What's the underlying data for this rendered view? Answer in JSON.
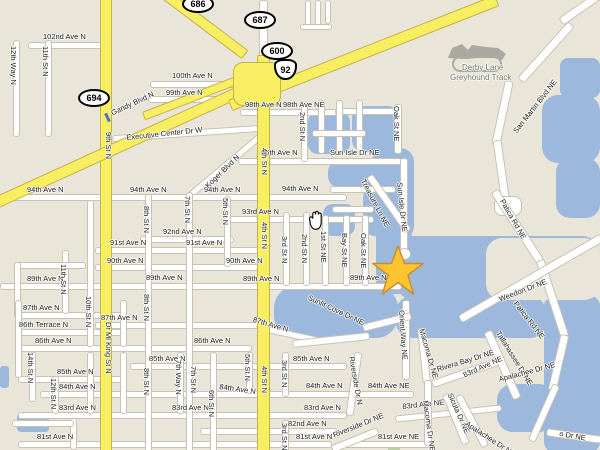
{
  "map": {
    "colors": {
      "land": "#E9E5D8",
      "water": "#9CB8DC",
      "road": "#FFFFFF",
      "highway": "#F7EE61",
      "highway_border": "#C6B14A",
      "building": "#A9A9A1",
      "star": "#FDC431",
      "star_border": "#C98F2F",
      "label": "#1c1c1c",
      "poi_label": "#6F7468"
    },
    "poi": {
      "derby_line1": "Derby Lane",
      "derby_line2": "Greyhound Track"
    },
    "marker": {
      "type": "star-icon"
    },
    "cursor": {
      "type": "hand-icon"
    },
    "shields": [
      {
        "t": "686",
        "x": 182,
        "y": -5,
        "k": "oval"
      },
      {
        "t": "687",
        "x": 244,
        "y": 11,
        "k": "oval"
      },
      {
        "t": "600",
        "x": 261,
        "y": 42,
        "k": "oval"
      },
      {
        "t": "92",
        "x": 274,
        "y": 59,
        "k": "us"
      },
      {
        "t": "694",
        "x": 78,
        "y": 89,
        "k": "oval"
      }
    ],
    "labels": [
      {
        "t": "102nd Ave N",
        "x": 43,
        "y": 33
      },
      {
        "t": "100th Ave N",
        "x": 172,
        "y": 72
      },
      {
        "t": "99th Ave N",
        "x": 166,
        "y": 89
      },
      {
        "t": "98th Ave N",
        "x": 245,
        "y": 101
      },
      {
        "t": "98th Ave NE",
        "x": 283,
        "y": 101
      },
      {
        "t": "96th Ave N",
        "x": 261,
        "y": 149
      },
      {
        "t": "Sun Isle Dr NE",
        "x": 330,
        "y": 149
      },
      {
        "t": "94th Ave N",
        "x": 27,
        "y": 186
      },
      {
        "t": "94th Ave N",
        "x": 130,
        "y": 186
      },
      {
        "t": "94th Ave N",
        "x": 204,
        "y": 186
      },
      {
        "t": "94th Ave N",
        "x": 282,
        "y": 185
      },
      {
        "t": "93rd Ave N",
        "x": 242,
        "y": 208
      },
      {
        "t": "92nd Ave N",
        "x": 163,
        "y": 228
      },
      {
        "t": "91st Ave N",
        "x": 110,
        "y": 239
      },
      {
        "t": "91st Ave N",
        "x": 186,
        "y": 239
      },
      {
        "t": "90th Ave N",
        "x": 107,
        "y": 257
      },
      {
        "t": "90th Ave N",
        "x": 226,
        "y": 257
      },
      {
        "t": "89th Ave N",
        "x": 27,
        "y": 275
      },
      {
        "t": "89th Ave N",
        "x": 146,
        "y": 274
      },
      {
        "t": "89th Ave N",
        "x": 243,
        "y": 275
      },
      {
        "t": "89th Ave N",
        "x": 350,
        "y": 274
      },
      {
        "t": "87th Ave N",
        "x": 23,
        "y": 304
      },
      {
        "t": "86th Terrace N",
        "x": 19,
        "y": 321
      },
      {
        "t": "86th Ave N",
        "x": 35,
        "y": 337
      },
      {
        "t": "86th Ave N",
        "x": 194,
        "y": 337
      },
      {
        "t": "87th Ave N",
        "x": 101,
        "y": 314
      },
      {
        "t": "87th Ave N",
        "x": 254,
        "y": 316,
        "r": 16
      },
      {
        "t": "85th Ave N",
        "x": 57,
        "y": 368
      },
      {
        "t": "85th Ave N",
        "x": 149,
        "y": 355
      },
      {
        "t": "85th Ave N",
        "x": 293,
        "y": 355
      },
      {
        "t": "84th Ave N",
        "x": 59,
        "y": 383
      },
      {
        "t": "84th Ave N",
        "x": 220,
        "y": 383,
        "r": 8
      },
      {
        "t": "84th Ave N",
        "x": 306,
        "y": 382
      },
      {
        "t": "84th Ave NE",
        "x": 368,
        "y": 382
      },
      {
        "t": "83rd Ave N",
        "x": 59,
        "y": 404
      },
      {
        "t": "83rd Ave N",
        "x": 172,
        "y": 404
      },
      {
        "t": "83rd Ave N",
        "x": 304,
        "y": 404
      },
      {
        "t": "83rd Ave NE",
        "x": 402,
        "y": 403,
        "r": -6
      },
      {
        "t": "83rd Ave NE",
        "x": 462,
        "y": 372,
        "r": -24
      },
      {
        "t": "82nd Ave N",
        "x": 288,
        "y": 420
      },
      {
        "t": "81st Ave N",
        "x": 37,
        "y": 433
      },
      {
        "t": "81st Ave N",
        "x": 296,
        "y": 433
      },
      {
        "t": "81st Ave NE",
        "x": 378,
        "y": 433
      },
      {
        "t": "12th Way N",
        "x": 17,
        "y": 46,
        "r": 90
      },
      {
        "t": "11th St N",
        "x": 49,
        "y": 46,
        "r": 90
      },
      {
        "t": "9th St N",
        "x": 112,
        "y": 132,
        "r": 90
      },
      {
        "t": "Gandy Blvd N",
        "x": 110,
        "y": 110,
        "r": -25
      },
      {
        "t": "Executive Center Dr W",
        "x": 126,
        "y": 134,
        "r": -6
      },
      {
        "t": "Koger Blvd N",
        "x": 204,
        "y": 184,
        "r": -44
      },
      {
        "t": "4th St N",
        "x": 268,
        "y": 148,
        "r": 90
      },
      {
        "t": "4th St N",
        "x": 268,
        "y": 222,
        "r": 90
      },
      {
        "t": "4th St N",
        "x": 268,
        "y": 366,
        "r": 90
      },
      {
        "t": "Dr Ml King St N",
        "x": 112,
        "y": 322,
        "r": 90
      },
      {
        "t": "2nd St N",
        "x": 306,
        "y": 112,
        "r": 90
      },
      {
        "t": "Oak St NE",
        "x": 400,
        "y": 106,
        "r": 90
      },
      {
        "t": "3rd St N",
        "x": 288,
        "y": 236,
        "r": 90
      },
      {
        "t": "2nd St N",
        "x": 308,
        "y": 234,
        "r": 90
      },
      {
        "t": "1st St NE",
        "x": 327,
        "y": 231,
        "r": 90
      },
      {
        "t": "Bay St NE",
        "x": 348,
        "y": 233,
        "r": 90
      },
      {
        "t": "Oak St NE",
        "x": 367,
        "y": 233,
        "r": 90
      },
      {
        "t": "7th St N",
        "x": 191,
        "y": 196,
        "r": 90
      },
      {
        "t": "5th St N",
        "x": 229,
        "y": 198,
        "r": 90
      },
      {
        "t": "8th St N",
        "x": 150,
        "y": 206,
        "r": 90
      },
      {
        "t": "8th St N",
        "x": 150,
        "y": 294,
        "r": 90
      },
      {
        "t": "10th St N",
        "x": 92,
        "y": 296,
        "r": 90
      },
      {
        "t": "11th St N",
        "x": 67,
        "y": 264,
        "r": 90
      },
      {
        "t": "7th St N",
        "x": 197,
        "y": 366,
        "r": 90
      },
      {
        "t": "7th Way N",
        "x": 182,
        "y": 360,
        "r": 90
      },
      {
        "t": "8th St N",
        "x": 150,
        "y": 368,
        "r": 90
      },
      {
        "t": "14th St N",
        "x": 34,
        "y": 352,
        "r": 90
      },
      {
        "t": "12th St N",
        "x": 57,
        "y": 378,
        "r": 90
      },
      {
        "t": "6th St N",
        "x": 215,
        "y": 390,
        "r": 90
      },
      {
        "t": "5th St N",
        "x": 251,
        "y": 354,
        "r": 90
      },
      {
        "t": "3rd St N",
        "x": 288,
        "y": 360,
        "r": 90
      },
      {
        "t": "3rd St N",
        "x": 288,
        "y": 423,
        "r": 90
      },
      {
        "t": "San Martin Blvd NE",
        "x": 512,
        "y": 130,
        "r": -52
      },
      {
        "t": "Patica Rd NE",
        "x": 505,
        "y": 198,
        "r": 60
      },
      {
        "t": "Patica Rd NE",
        "x": 518,
        "y": 300,
        "r": 52
      },
      {
        "t": "Weedon Dr NE",
        "x": 498,
        "y": 296,
        "r": -21
      },
      {
        "t": "Treasure Ln NE",
        "x": 366,
        "y": 178,
        "r": 62
      },
      {
        "t": "Sun Isle Dr NE",
        "x": 403,
        "y": 182,
        "r": 84
      },
      {
        "t": "Sunlit Cove Dr NE",
        "x": 310,
        "y": 294,
        "r": 25
      },
      {
        "t": "Orient Way NE",
        "x": 405,
        "y": 310,
        "r": 86
      },
      {
        "t": "Macoma Dr NE",
        "x": 425,
        "y": 328,
        "r": 74
      },
      {
        "t": "Macoma Dr NE",
        "x": 429,
        "y": 400,
        "r": 82
      },
      {
        "t": "Rivera Bay Dr NE",
        "x": 436,
        "y": 366,
        "r": -17
      },
      {
        "t": "Tallahassee Dr NE",
        "x": 501,
        "y": 330,
        "r": 58
      },
      {
        "t": "Sicuta Dr NE",
        "x": 453,
        "y": 392,
        "r": 66
      },
      {
        "t": "Apalachee Dr NE",
        "x": 498,
        "y": 376,
        "r": -15
      },
      {
        "t": "Apalachee Dr NE",
        "x": 468,
        "y": 420,
        "r": 33
      },
      {
        "t": "Riverside Dr N",
        "x": 355,
        "y": 356,
        "r": 80
      },
      {
        "t": "Riverside Dr NE",
        "x": 332,
        "y": 432,
        "r": -22
      },
      {
        "t": "o Dr NE",
        "x": 560,
        "y": 430,
        "r": 10
      },
      {
        "t": "Derby Lane",
        "x": 462,
        "y": 64,
        "c": "#6F7468",
        "fs": 8
      },
      {
        "t": "Greyhound Track",
        "x": 450,
        "y": 74,
        "c": "#6F7468",
        "fs": 8
      }
    ]
  }
}
